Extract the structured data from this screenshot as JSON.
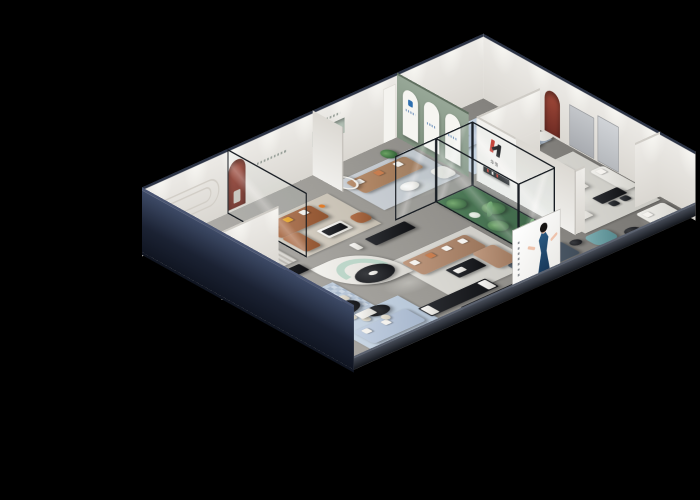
{
  "scene": {
    "title": "3D cutaway render of a furniture brand showroom",
    "style": "isometric dollhouse view on black background",
    "background": "#000000"
  },
  "branding": {
    "logo_letter": "H",
    "logo_sub": "华饱",
    "storefront_sign": "H 华饱",
    "logo_red": "#c2342a",
    "logo_black": "#17181b"
  },
  "poster": {
    "name": "fashion-model-billboard",
    "description": "woman in navy-blue halter dress on white backdrop with vertical caption text",
    "dress_color": "#1d3a5f"
  },
  "arch_posters": {
    "count": 3,
    "wall_color": "#8fa08f",
    "accent": "#2e6fb0",
    "description": "white arched poster niches on sage-green accent wall"
  },
  "palette": {
    "outer_wall_navy": "#1b2233",
    "inner_wall": "#edebe7",
    "floor_gray": "#9b9994",
    "accent_red_niche": "#8a3a30",
    "sofa_teal": "#4f6a6a",
    "sofa_caramel": "#a2623d",
    "sofa_tan": "#a87f5d",
    "sofa_powder_blue": "#aebfd8",
    "sofa_white": "#e8e7e2",
    "mint_bench": "#bcd6c9",
    "atrium_green": "#3f7d4a"
  },
  "rooms": [
    {
      "id": "lounge-a",
      "label": "teal sofa lounge",
      "furniture": [
        "teal-fabric-sofa",
        "round-white-coffee-table",
        "leather-armchair",
        "potted-plant",
        "striped-rug",
        "stadium-groove-wall-decor"
      ]
    },
    {
      "id": "lounge-b",
      "label": "caramel leather lounge",
      "furniture": [
        "caramel-leather-sectional",
        "black-white-coffee-table",
        "red-arched-niche",
        "orange-armchair",
        "beige-rug",
        "glass-partition"
      ]
    },
    {
      "id": "lounge-c",
      "label": "tan sofa lounge",
      "furniture": [
        "tan-leather-sofa",
        "white-armchair",
        "round-side-table",
        "mint-recessed-shelf",
        "ring-floor-lamp",
        "potted-plant"
      ]
    },
    {
      "id": "studio-d",
      "label": "powder-blue sofa studio",
      "furniture": [
        "powder-blue-sofa",
        "sage-loveseat",
        "office-desk-with-chairs",
        "round-table",
        "pair-of-white-armchairs",
        "cool-blue-rug"
      ]
    },
    {
      "id": "suite-e",
      "label": "white sofa suite",
      "furniture": [
        "white-l-shaped-sofa",
        "white-chaise",
        "black-writing-desk",
        "black-side-chairs",
        "white-sideboard",
        "wall-media-ledge",
        "red-arched-niche",
        "gray-tv-panel"
      ]
    },
    {
      "id": "hall-center",
      "label": "central showroom hall",
      "furniture": [
        "curved-white-partition",
        "mint-curved-bench",
        "black-oval-display-table",
        "caramel-l-sectional",
        "black-coffee-table",
        "glass-plant-atrium",
        "cacti",
        "display-benches",
        "cafe-oval-tables",
        "cream-dining-chairs",
        "bar-stools",
        "red-display-shelf",
        "black-sideboard",
        "powder-blue-loveseat",
        "slate-blue-sofa",
        "teal-ottoman",
        "pixel-pattern-rug",
        "model-billboard",
        "storefront-sign"
      ]
    }
  ]
}
